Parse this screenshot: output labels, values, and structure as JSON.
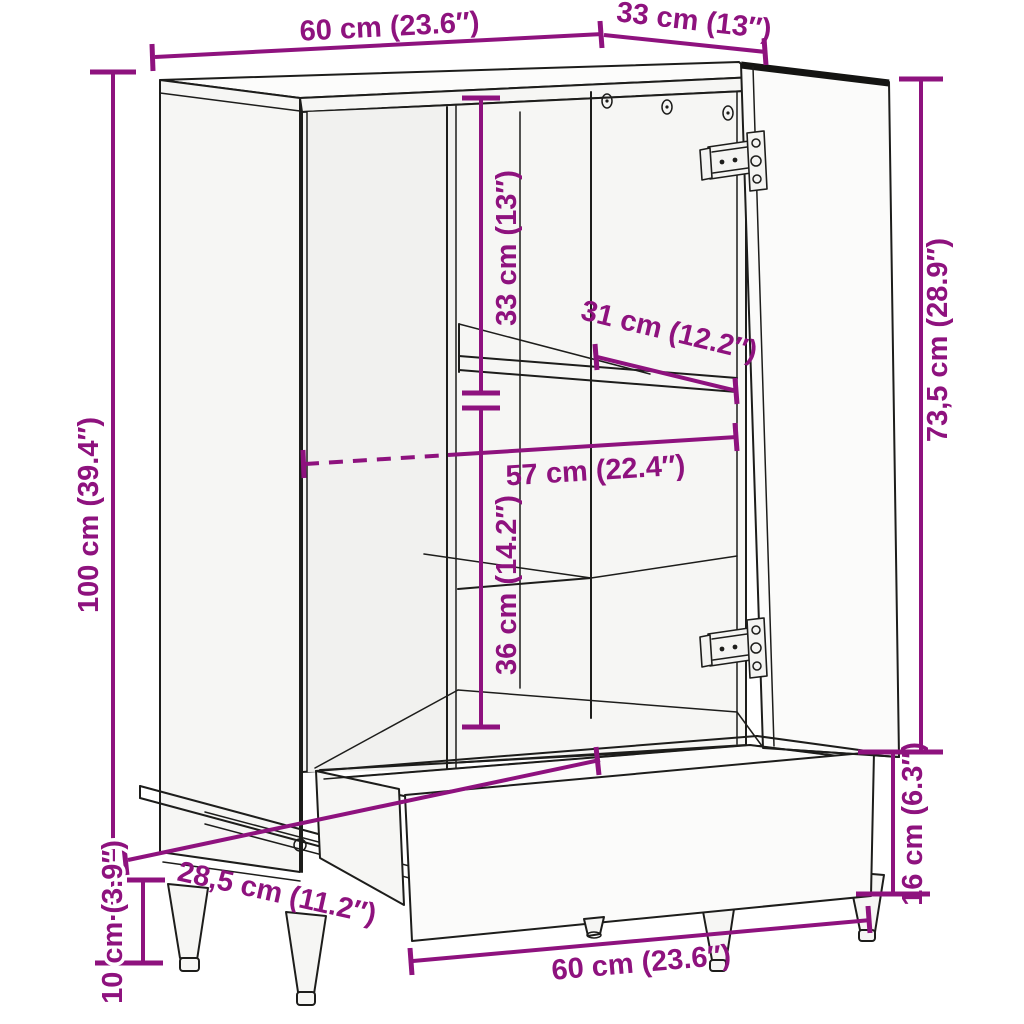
{
  "colors": {
    "dimension_accent": "#8E127E",
    "line_art": "#1d1d1b",
    "background": "#ffffff",
    "panel_fill": "#f6f6f4"
  },
  "dims": {
    "top_width": "60 cm (23.6″)",
    "top_depth": "33 cm (13″)",
    "height_total": "100 cm (39.4″)",
    "upper_inner_height": "33 cm (13″)",
    "shelf_depth": "31 cm (12.2″)",
    "inner_width": "57 cm (22.4″)",
    "lower_inner_height": "36 cm (14.2″)",
    "door_height": "73,5 cm (28.9″)",
    "drawer_front_height": "16 cm (6.3″)",
    "drawer_slide_length": "28,5 cm (11.2″)",
    "leg_height": "10 cm (3.9″)",
    "base_width": "60 cm (23.6″)"
  }
}
